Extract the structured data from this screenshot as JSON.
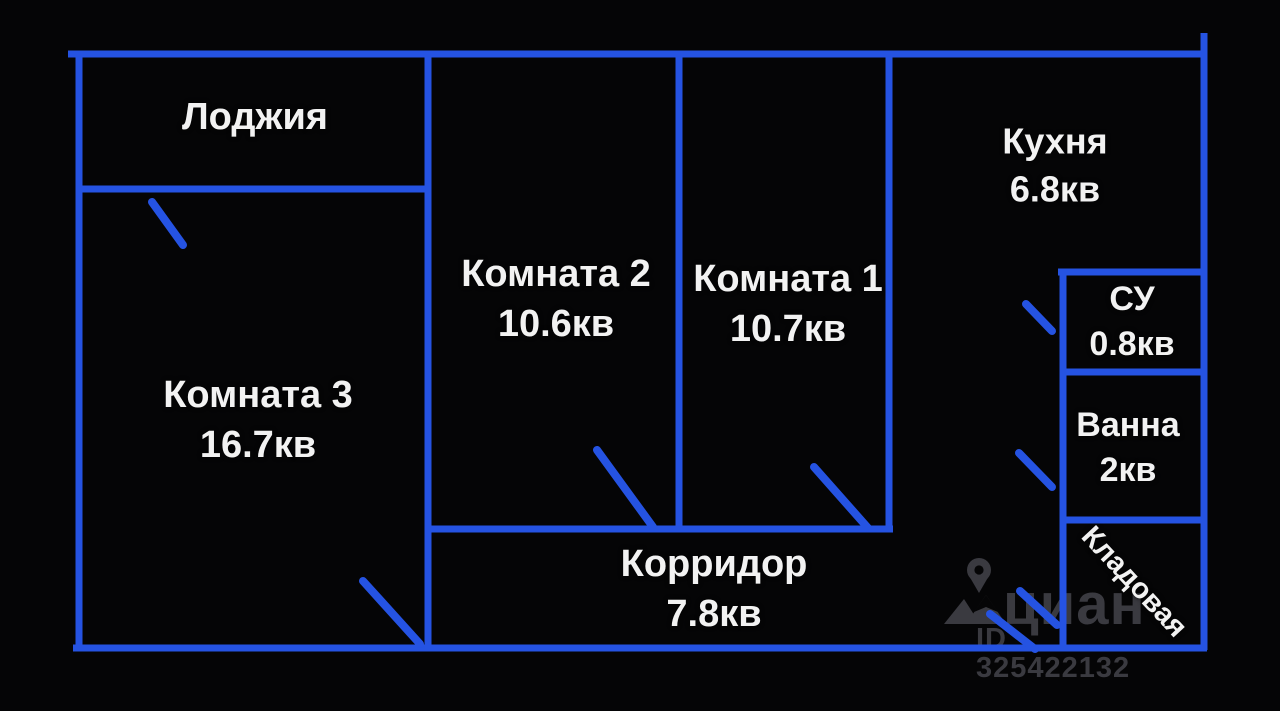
{
  "plan_title": "floor-plan",
  "rooms": {
    "loggia": {
      "name": "Лоджия"
    },
    "room2": {
      "name": "Комната 2",
      "area": "10.6кв"
    },
    "room1": {
      "name": "Комната 1",
      "area": "10.7кв"
    },
    "room3": {
      "name": "Комната 3",
      "area": "16.7кв"
    },
    "kitchen": {
      "name": "Кухня",
      "area": "6.8кв"
    },
    "su": {
      "name": "СУ",
      "area": "0.8кв"
    },
    "bath": {
      "name": "Ванна",
      "area": "2кв"
    },
    "corridor": {
      "name": "Корридор",
      "area": "7.8кв"
    },
    "storage": {
      "name": "Кладовая"
    }
  },
  "watermark": {
    "brand": "циан",
    "listing_id": "ID 325422132"
  },
  "colors": {
    "wall": "#2553e2",
    "label": "#f2f2f2",
    "watermark": "#3a3a40",
    "background": "#050506"
  }
}
